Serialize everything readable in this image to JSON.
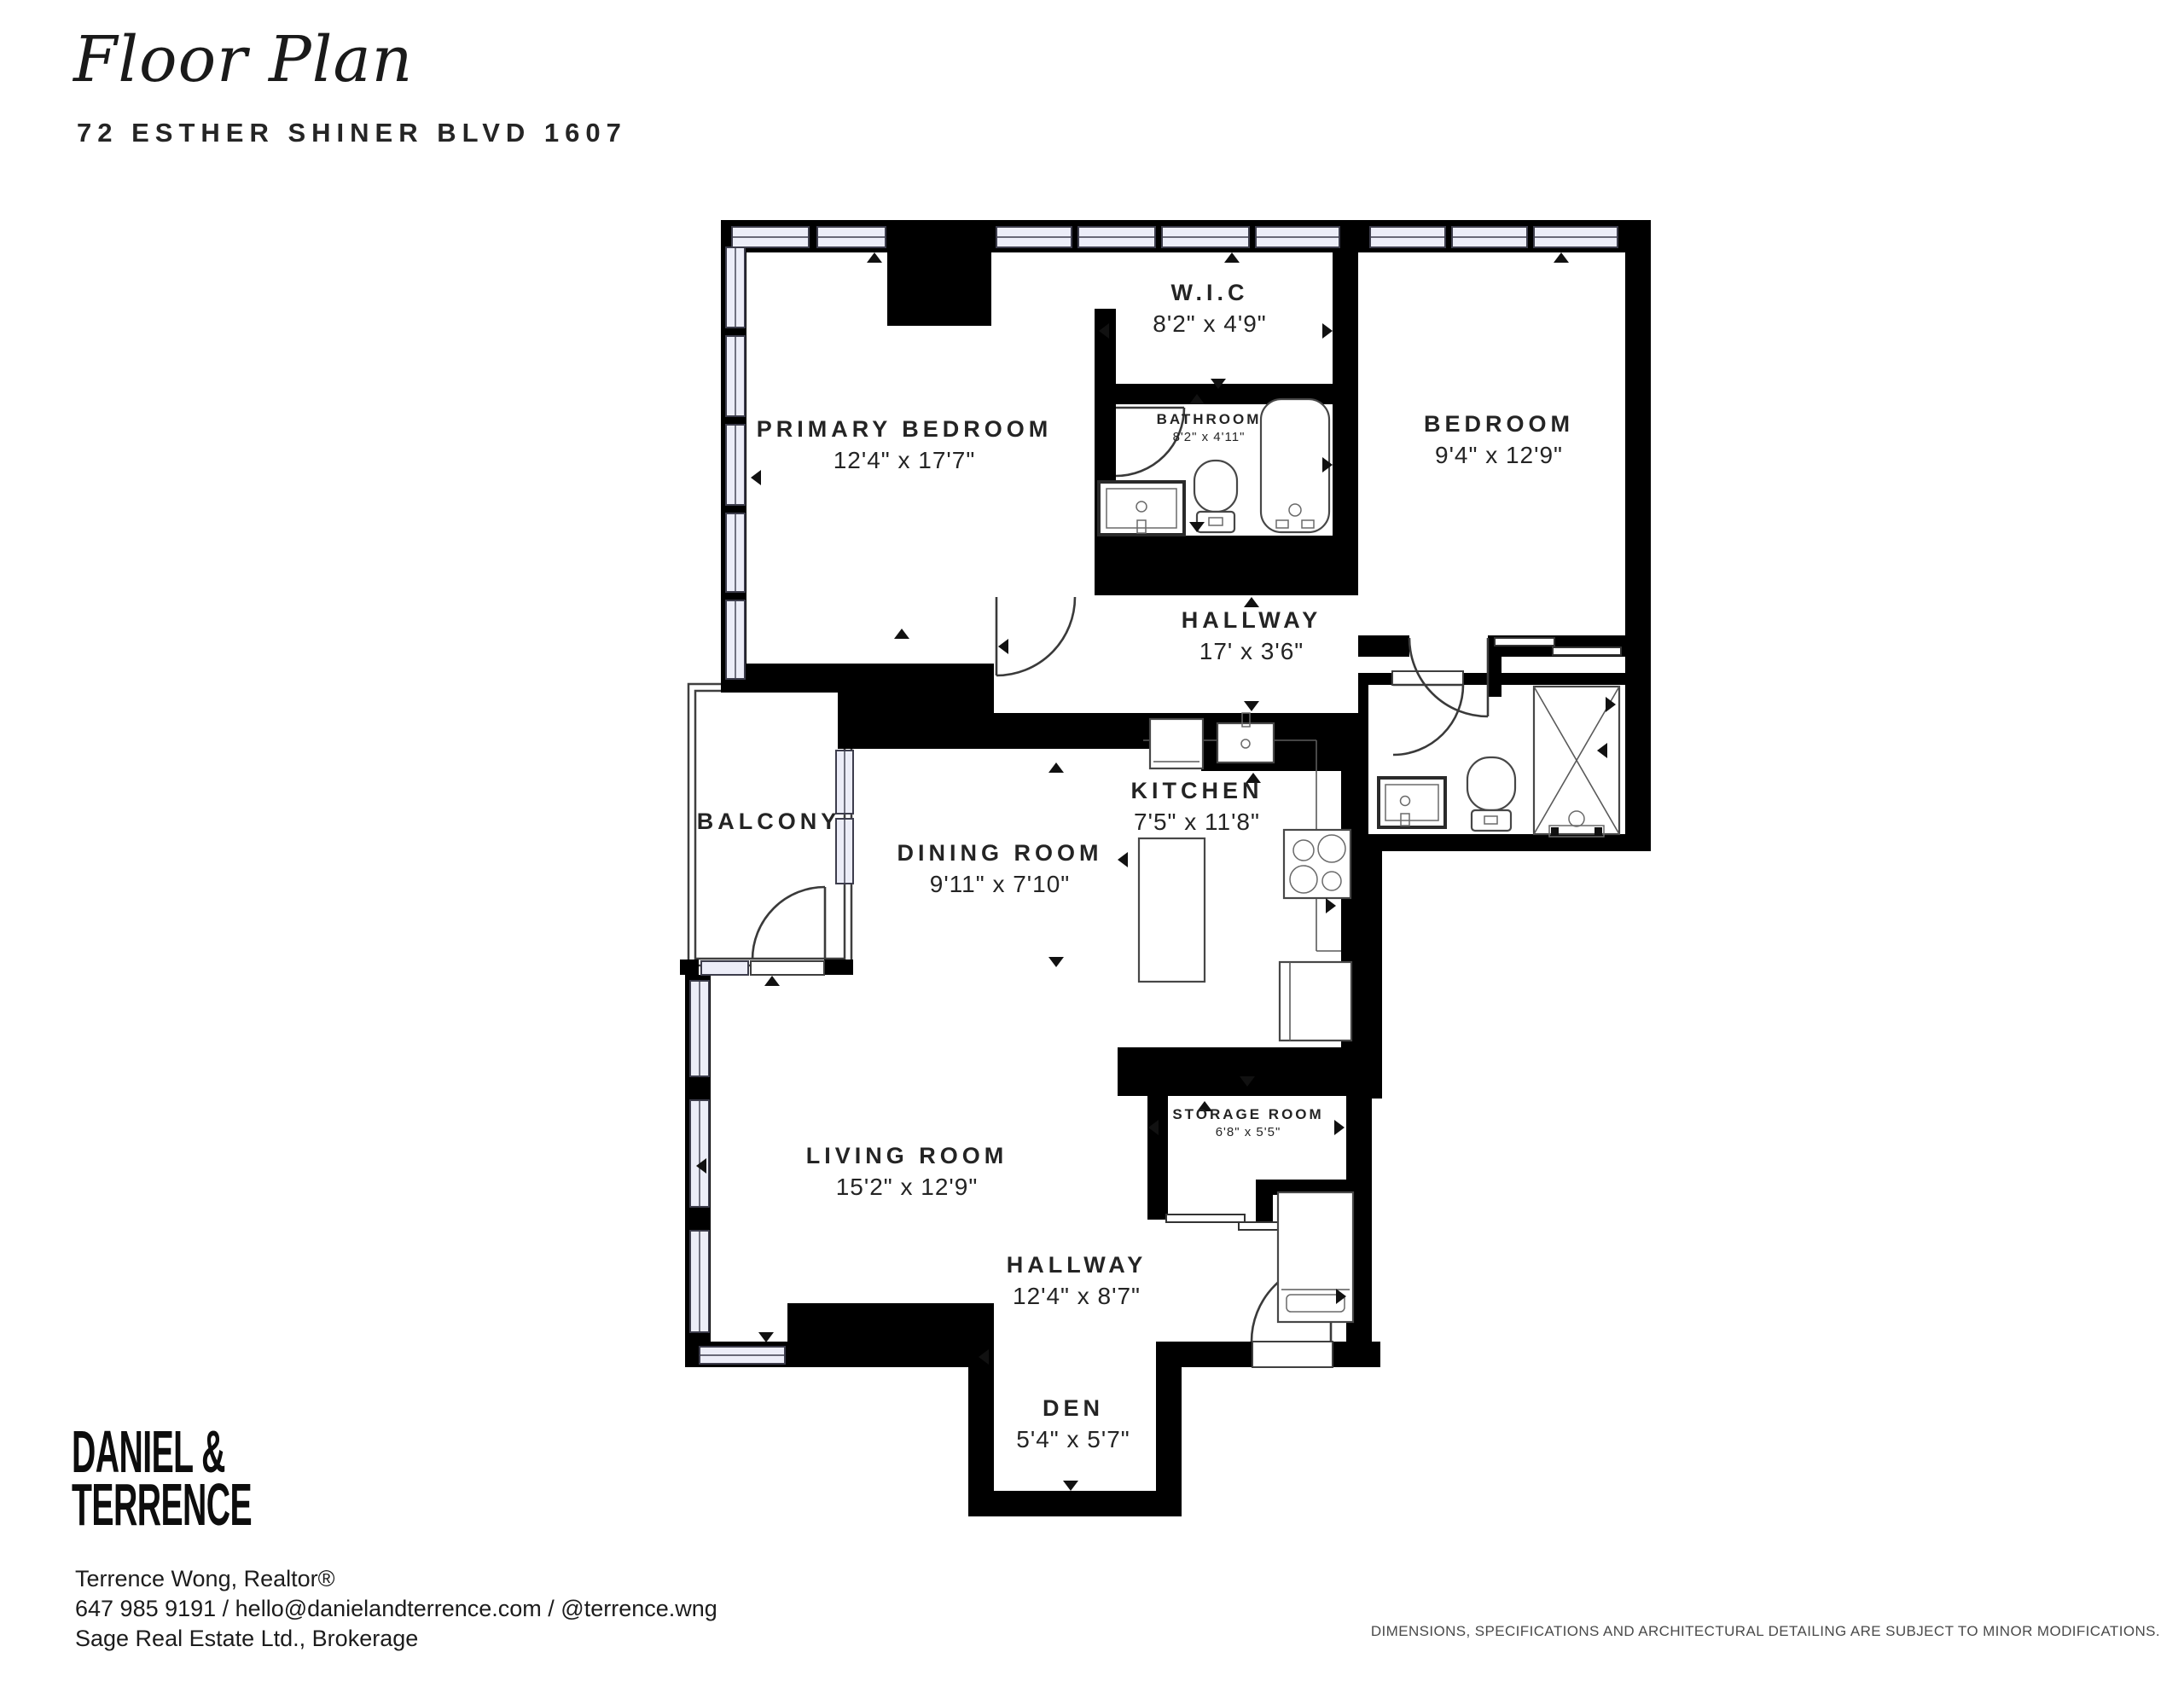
{
  "header": {
    "title": "Floor Plan",
    "address": "72 ESTHER SHINER BLVD 1607"
  },
  "rooms": [
    {
      "name": "W.I.C",
      "dims": "8'2\" x 4'9\""
    },
    {
      "name": "BATHROOM",
      "dims": "8'2\" x 4'11\""
    },
    {
      "name": "PRIMARY BEDROOM",
      "dims": "12'4\" x 17'7\""
    },
    {
      "name": "BEDROOM",
      "dims": "9'4\" x 12'9\""
    },
    {
      "name": "HALLWAY",
      "dims": "17' x 3'6\""
    },
    {
      "name": "BALCONY",
      "dims": ""
    },
    {
      "name": "DINING ROOM",
      "dims": "9'11\" x 7'10\""
    },
    {
      "name": "KITCHEN",
      "dims": "7'5\" x 11'8\""
    },
    {
      "name": "LIVING ROOM",
      "dims": "15'2\" x 12'9\""
    },
    {
      "name": "STORAGE ROOM",
      "dims": "6'8\" x 5'5\""
    },
    {
      "name": "HALLWAY",
      "dims": "12'4\" x 8'7\""
    },
    {
      "name": "DEN",
      "dims": "5'4\" x 5'7\""
    }
  ],
  "footer": {
    "logo_line1": "DANIEL &",
    "logo_line2": "TERRENCE",
    "agent": "Terrence Wong, Realtor®",
    "contact": "647 985 9191 / hello@danielandterrence.com / @terrence.wng",
    "brokerage": "Sage Real Estate Ltd., Brokerage",
    "disclaimer": "DIMENSIONS, SPECIFICATIONS AND ARCHITECTURAL DETAILING ARE SUBJECT TO MINOR MODIFICATIONS."
  },
  "colors": {
    "wall": "#000000",
    "window_fill": "#ecedf8",
    "window_stroke": "#3d3d4c",
    "fixture_stroke": "#474747",
    "text": "#222222",
    "muted": "#4a4a4a"
  }
}
